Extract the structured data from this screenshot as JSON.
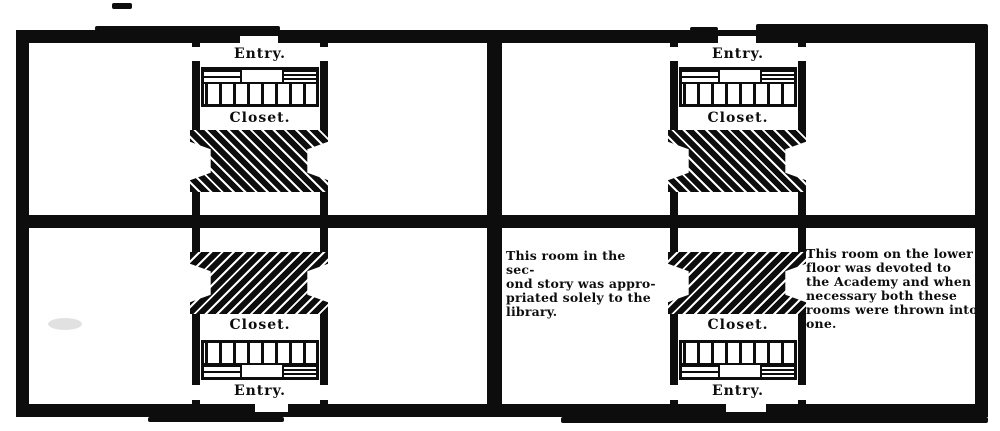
{
  "figure": {
    "kind": "scanned floor-plan engraving, two identical building plans side by side",
    "ink_color": "#0d0d0d",
    "paper_color": "#ffffff"
  },
  "plans": [
    {
      "name": "left-plan",
      "upper": {
        "entry": "Entry.",
        "closet": "Closet."
      },
      "lower": {
        "closet": "Closet.",
        "entry": "Entry."
      }
    },
    {
      "name": "right-plan",
      "upper": {
        "entry": "Entry.",
        "closet": "Closet."
      },
      "lower": {
        "closet": "Closet.",
        "entry": "Entry."
      },
      "left_room_note": {
        "lines": [
          "This room in the sec-",
          "ond story was appro-",
          "priated solely to the",
          "library."
        ]
      },
      "right_room_note": {
        "lines": [
          "This room on the lower",
          "floor was devoted to",
          "the Academy and when",
          "necessary both these",
          "rooms were thrown into",
          "one."
        ]
      }
    }
  ]
}
